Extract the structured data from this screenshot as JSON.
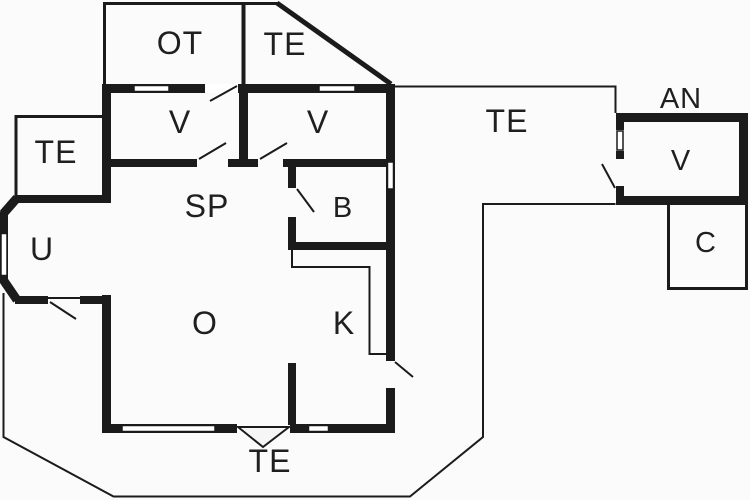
{
  "plan": {
    "type": "holiday-home-floor-plan",
    "colors": {
      "wall": "#1b1b1b",
      "thin_line": "#1b1b1b",
      "background": "#fbfbfb",
      "room_fill": "#ffffff",
      "label_text": "#1f1f1f"
    },
    "rooms": [
      {
        "id": "ot",
        "label": "OT"
      },
      {
        "id": "te_top",
        "label": "TE"
      },
      {
        "id": "v_left",
        "label": "V"
      },
      {
        "id": "v_right",
        "label": "V"
      },
      {
        "id": "te_left",
        "label": "TE"
      },
      {
        "id": "sp",
        "label": "SP"
      },
      {
        "id": "b",
        "label": "B"
      },
      {
        "id": "u",
        "label": "U"
      },
      {
        "id": "o",
        "label": "O"
      },
      {
        "id": "k",
        "label": "K"
      },
      {
        "id": "te_main",
        "label": "TE"
      },
      {
        "id": "te_bottom",
        "label": "TE"
      },
      {
        "id": "an",
        "label": "AN"
      },
      {
        "id": "v_annex",
        "label": "V"
      },
      {
        "id": "c",
        "label": "C"
      }
    ]
  }
}
